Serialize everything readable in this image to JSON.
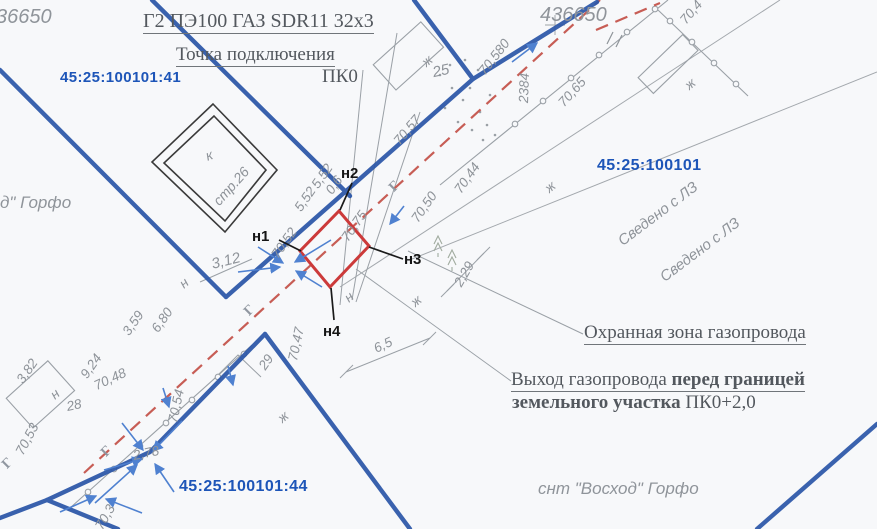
{
  "colors": {
    "boundary_blue": "#2b56a8",
    "cadastral_text_blue": "#1d55b8",
    "pipeline_red": "#c75d55",
    "survey_square_red": "#cc3a3a",
    "survey_grey": "#8e9399",
    "annotation_grey": "#53585e",
    "arrow_blue": "#4f81d0"
  },
  "map": {
    "grid_coordinate_top_left": "36650",
    "grid_coordinate_top": "436650",
    "cadastral": {
      "parcel_41": "45:25:100101:41",
      "quarter": "45:25:100101",
      "parcel_44": "45:25:100101:44"
    },
    "places": {
      "left_edge": "д\" Горфо",
      "bottom": "снт \"Восход\" Горфо"
    },
    "annotations": {
      "pipe_spec": "Г2 ПЭ100 ГАЗ SDR11 32x3",
      "connection_line1": "Точка подключения",
      "connection_line2": "ПК0",
      "protection_zone": "Охранная зона газопровода",
      "outlet_l1_a": "Выход газопровода ",
      "outlet_l1_b": "перед границей",
      "outlet_l2_a": "земельного участка ",
      "outlet_l2_b": "ПК0+2,0",
      "merged_1": "Сведено с ЛЗ",
      "merged_2": "Сведено с ЛЗ"
    },
    "points": {
      "n1": "н1",
      "n2": "н2",
      "n3": "н3",
      "n4": "н4"
    },
    "building": {
      "letter": "к",
      "label": "стр.26"
    },
    "gas_letter": "Г",
    "marks": [
      "70,57",
      "70,580",
      "2384",
      "70,65",
      "70,4",
      "70,52",
      "5,52",
      "5,52",
      "0,6",
      "70,75",
      "70,50",
      "70,44",
      "2,29",
      "6,5",
      "29",
      "70,47",
      "3,12",
      "3,59",
      "6,80",
      "9,24",
      "3,82",
      "28",
      "70,48",
      "70,53",
      "70,54",
      "2,78",
      "70,3",
      "ж",
      "ж",
      "ж",
      "ж",
      "ж",
      "25",
      "н",
      "н",
      "н"
    ]
  }
}
